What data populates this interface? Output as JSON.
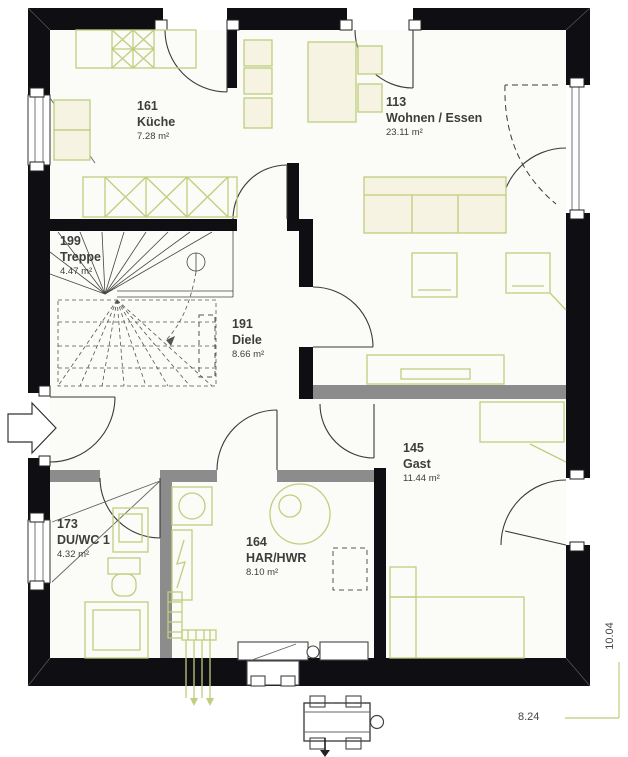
{
  "plan": {
    "title": "Erdgeschoss Grundriss",
    "rooms": [
      {
        "id": "kueche",
        "number": "161",
        "name": "Küche",
        "area": "7.28 m²"
      },
      {
        "id": "wohnen",
        "number": "113",
        "name": "Wohnen / Essen",
        "area": "23.11 m²"
      },
      {
        "id": "treppe",
        "number": "199",
        "name": "Treppe",
        "area": "4.47 m²"
      },
      {
        "id": "diele",
        "number": "191",
        "name": "Diele",
        "area": "8.66 m²"
      },
      {
        "id": "gast",
        "number": "145",
        "name": "Gast",
        "area": "11.44 m²"
      },
      {
        "id": "duwc",
        "number": "173",
        "name": "DU/WC 1",
        "area": "4.32 m²"
      },
      {
        "id": "har",
        "number": "164",
        "name": "HAR/HWR",
        "area": "8.10 m²"
      }
    ],
    "dimensions": {
      "height": "10.04",
      "width": "8.24"
    },
    "colors": {
      "wall": "#0e0e13",
      "interior_wall": "#8c8c8c",
      "furniture_line": "#bfce7f",
      "furniture_fill": "#f6f3e2",
      "dimension_line": "#c9d48e",
      "label_text": "#3d3d3d",
      "door_line": "#3a3a3a"
    }
  }
}
